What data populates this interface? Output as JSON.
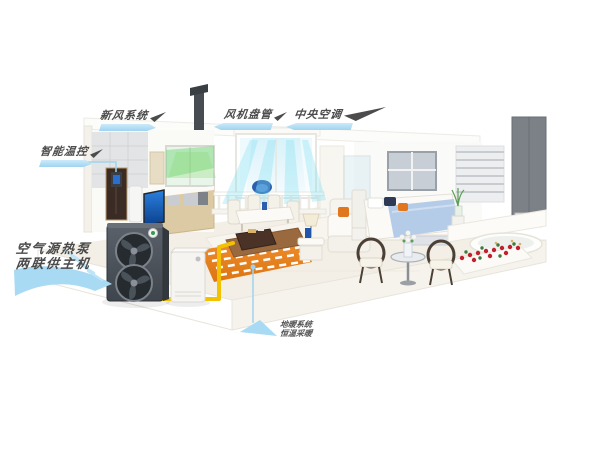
{
  "callouts": {
    "fresh_air": {
      "label": "新风系统"
    },
    "fan_coil": {
      "label": "风机盘管"
    },
    "central_ac": {
      "label": "中央空调"
    },
    "smart_control": {
      "label": "智能温控"
    },
    "heat_pump_unit": {
      "line1": "空气源热泵",
      "line2": "两联供主机"
    },
    "floor_heating": {
      "line1": "地暖系统",
      "line2": "恒温采暖"
    }
  },
  "colors": {
    "callout_blue": "#9ed3f0",
    "label_text": "#4c4c4c",
    "pipe_yellow": "#f2c200",
    "floor_heating_orange": "#e8821e",
    "airflow_cyan": "#7fe0f2",
    "fresh_air_green": "#62d06a",
    "heat_pump_gray": "#4b5157"
  }
}
